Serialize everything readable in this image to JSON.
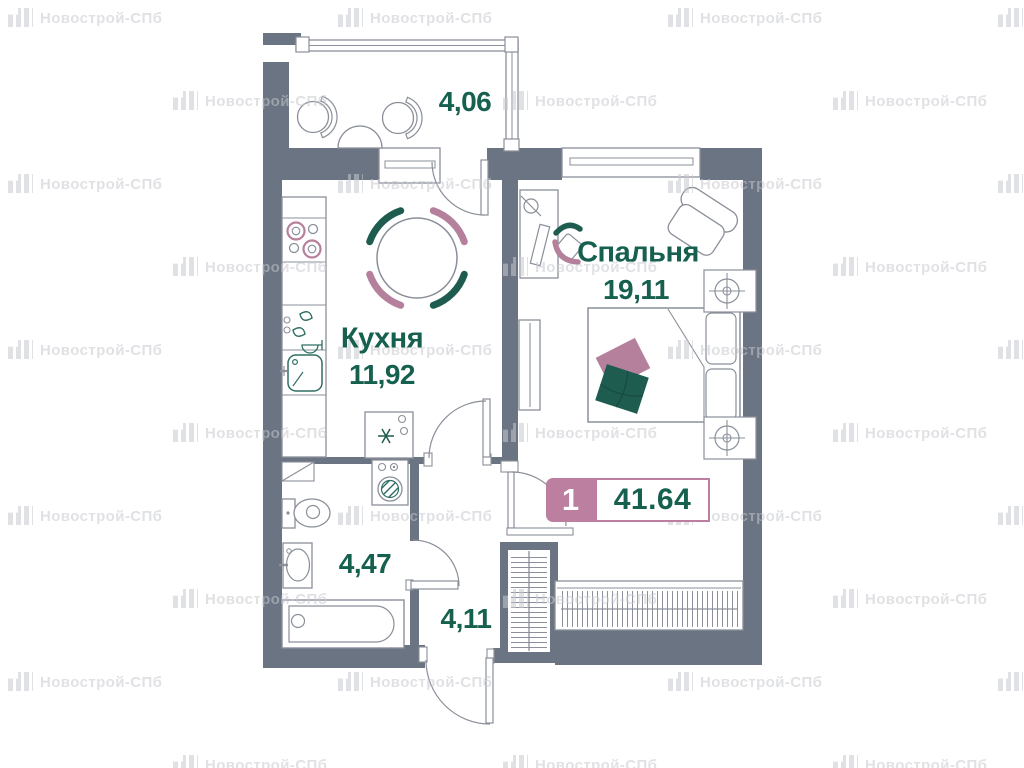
{
  "watermark": {
    "text": "Новострой-СПб"
  },
  "plan": {
    "rooms": [
      {
        "id": "balcony",
        "name": "",
        "area": "4,06"
      },
      {
        "id": "kitchen",
        "name": "Кухня",
        "area": "11,92"
      },
      {
        "id": "bedroom",
        "name": "Спальня",
        "area": "19,11"
      },
      {
        "id": "bathroom",
        "name": "",
        "area": "4,47"
      },
      {
        "id": "hallway",
        "name": "",
        "area": "4,11"
      }
    ],
    "badge": {
      "rooms_count": "1",
      "total_area": "41.64"
    },
    "colors": {
      "wall": "#6b7482",
      "line": "#8a8f99",
      "teal_text": "#16604f",
      "teal": "#1f5c50",
      "teal_line": "#2f6f63",
      "pink": "#b5809c",
      "badge_pink": "#bc7fa0",
      "watermark": "rgba(198,200,205,0.55)"
    }
  }
}
